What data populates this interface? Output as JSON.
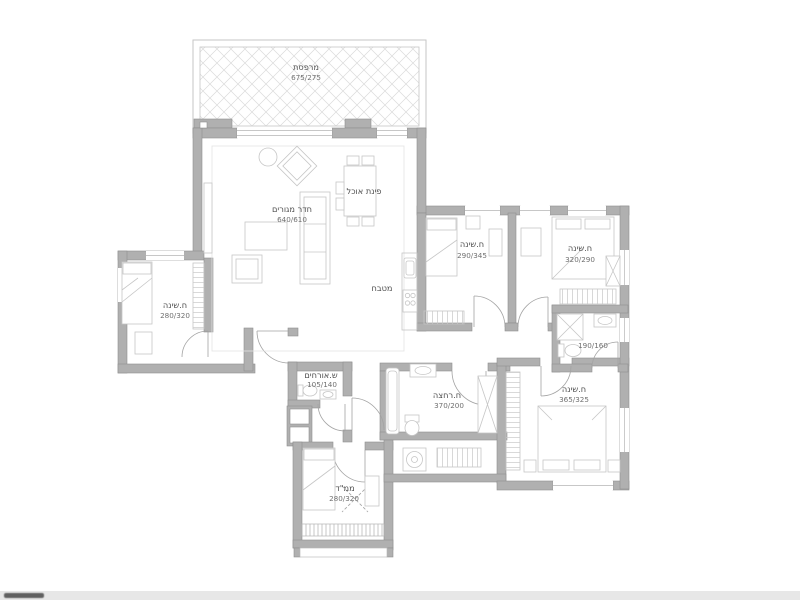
{
  "rooms": {
    "balcony": {
      "name": "מרפסת",
      "dims": "675/275"
    },
    "living": {
      "name": "חדר מגורים",
      "dims": "640/610"
    },
    "dining": {
      "name": "פינת אוכל"
    },
    "kitchen": {
      "name": "מטבח"
    },
    "bedroom_left": {
      "name": "ח.שינה",
      "dims": "280/320"
    },
    "bedroom_mid": {
      "name": "ח.שינה",
      "dims": "290/345"
    },
    "bedroom_right": {
      "name": "ח.שינה",
      "dims": "320/290"
    },
    "shower_room": {
      "dims": "190/160"
    },
    "guest_wc": {
      "name": "ש.אורחים",
      "dims": "105/140"
    },
    "bathroom": {
      "name": "ח.רחצה",
      "dims": "370/200"
    },
    "master_bedroom": {
      "name": "ח.שינה",
      "dims": "365/325"
    },
    "safe_room": {
      "name": "ממ\"ד",
      "dims": "280/320"
    }
  },
  "colors": {
    "wall_fill": "#b0b0b0",
    "wall_stroke": "#8f8f8f",
    "furniture_line": "#c6c6c6",
    "door_arc": "#a3a3a3",
    "hatch_line": "#d9d9d9",
    "label_text": "#4f4f4f",
    "dims_text": "#6f6f6f",
    "footer_bar": "#e7e7e7"
  }
}
